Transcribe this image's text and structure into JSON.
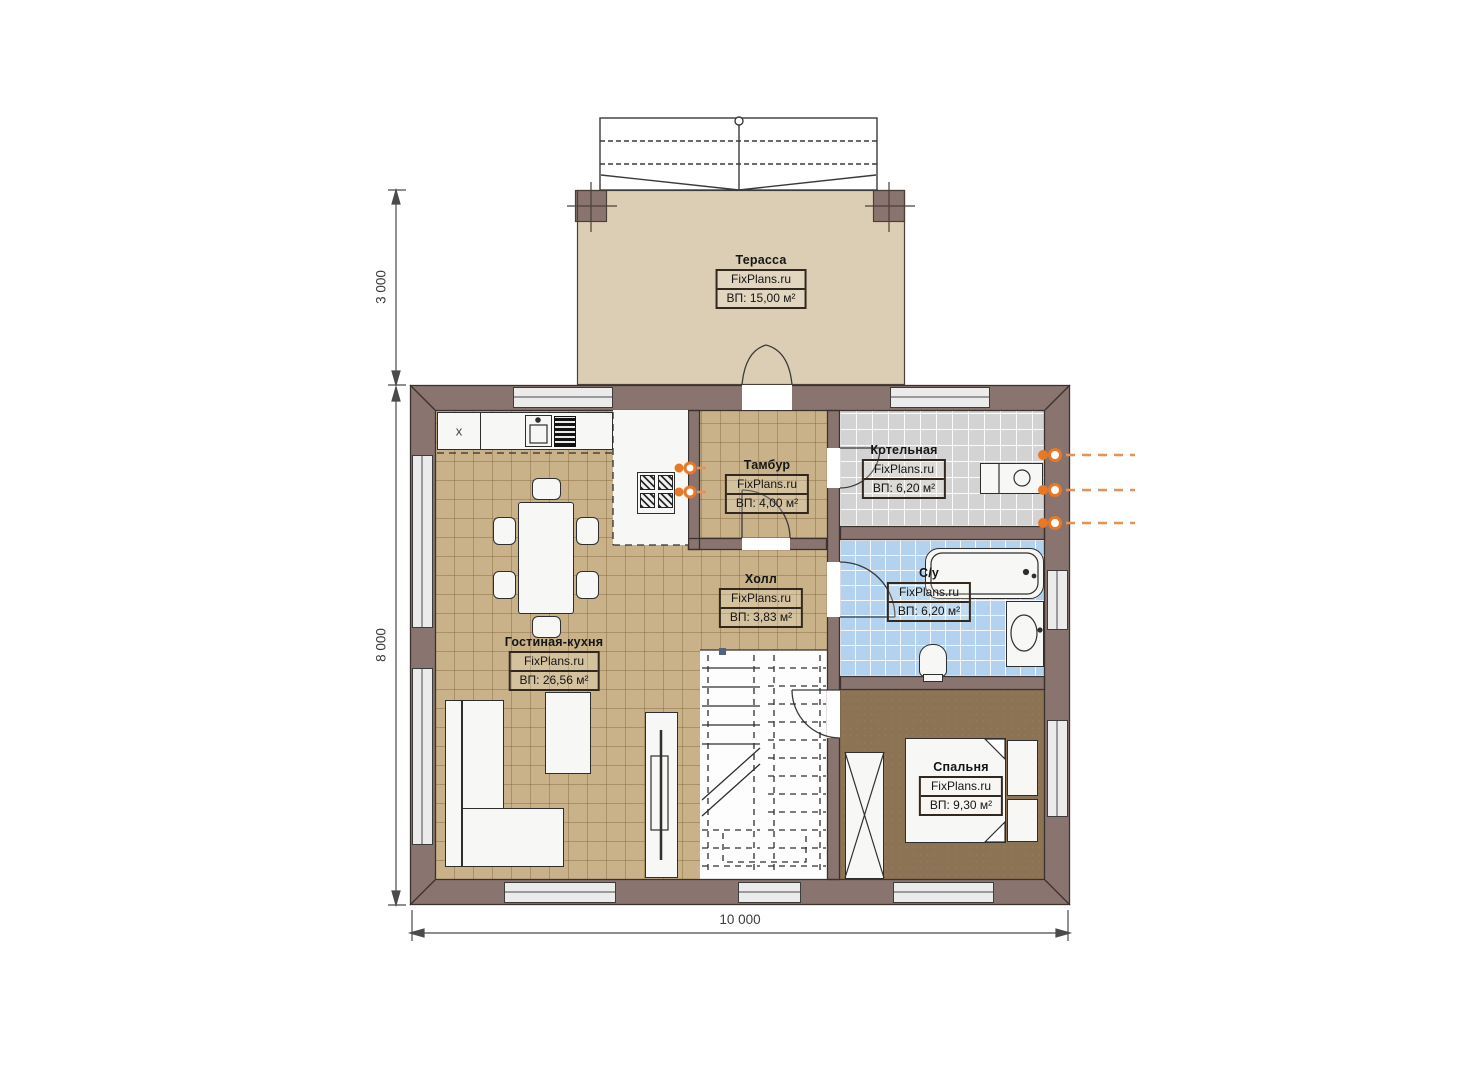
{
  "rooms": [
    {
      "name": "Терасса",
      "brand": "FixPlans.ru",
      "area": "ВП: 15,00 м²"
    },
    {
      "name": "Тамбур",
      "brand": "FixPlans.ru",
      "area": "ВП: 4,00 м²"
    },
    {
      "name": "Котельная",
      "brand": "FixPlans.ru",
      "area": "ВП: 6,20 м²"
    },
    {
      "name": "Холл",
      "brand": "FixPlans.ru",
      "area": "ВП: 3,83 м²"
    },
    {
      "name": "С/у",
      "brand": "FixPlans.ru",
      "area": "ВП: 6,20 м²"
    },
    {
      "name": "Гостиная-кухня",
      "brand": "FixPlans.ru",
      "area": "ВП: 26,56 м²"
    },
    {
      "name": "Спальня",
      "brand": "FixPlans.ru",
      "area": "ВП: 9,30 м²"
    }
  ],
  "dimensions": {
    "terrace_depth": "3 000",
    "house_depth": "8 000",
    "house_width": "10 000"
  },
  "marks": {
    "cabinet_cross": "x"
  },
  "colors": {
    "wall": "#8a7470",
    "floor_tile_tan": "#c9b28a",
    "floor_tile_gray": "#d3d3d3",
    "floor_tile_blue": "#b2d2f0",
    "floor_bedroom": "#8b7354",
    "terrace_floor": "#dbceb5",
    "pipe_accent": "#e87826"
  }
}
